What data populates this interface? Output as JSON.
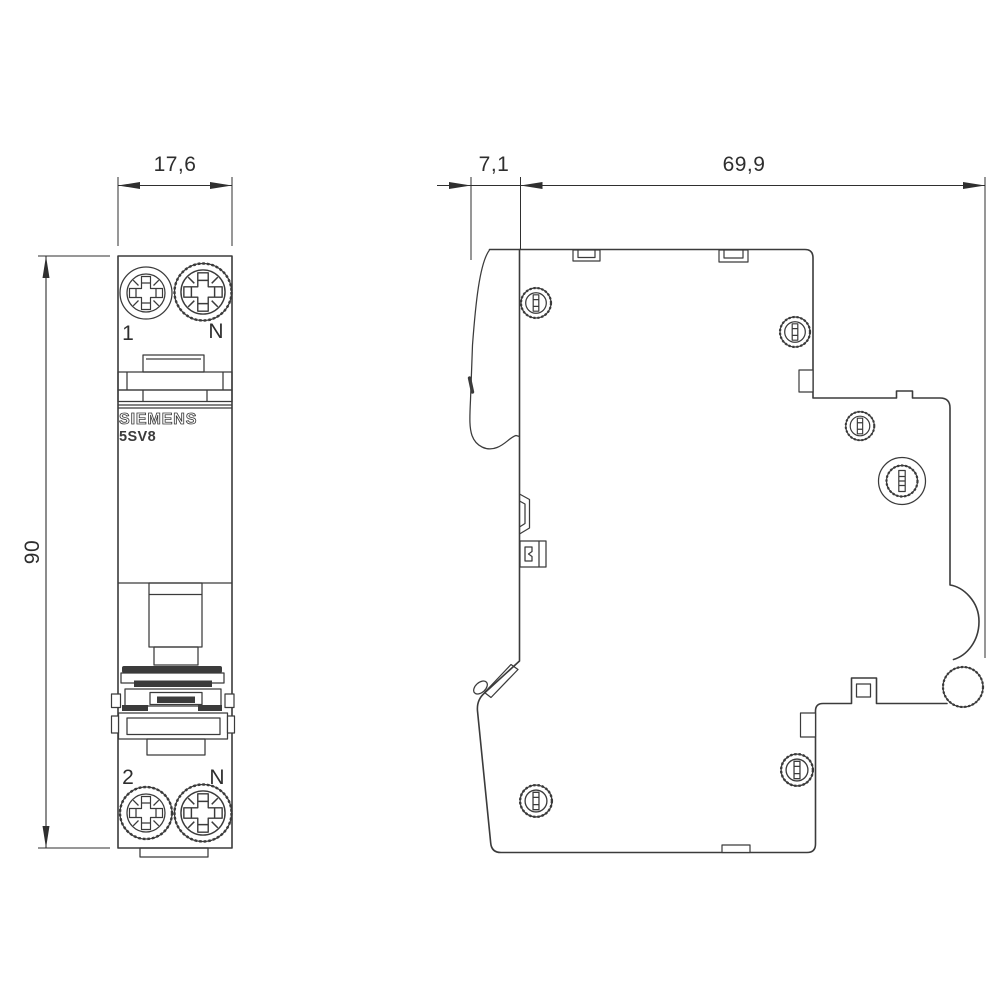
{
  "colors": {
    "line": "#3b3b3b",
    "background": "#ffffff",
    "text": "#2e2e2e"
  },
  "front_view": {
    "width_dim": "17,6",
    "height_dim": "90",
    "brand": "SIEMENS",
    "model": "5SV8",
    "terminal_labels": {
      "top_left": "1",
      "top_right": "N",
      "bottom_left": "2",
      "bottom_right": "N"
    }
  },
  "side_view": {
    "toggle_depth_dim": "7,1",
    "body_depth_dim": "69,9"
  }
}
